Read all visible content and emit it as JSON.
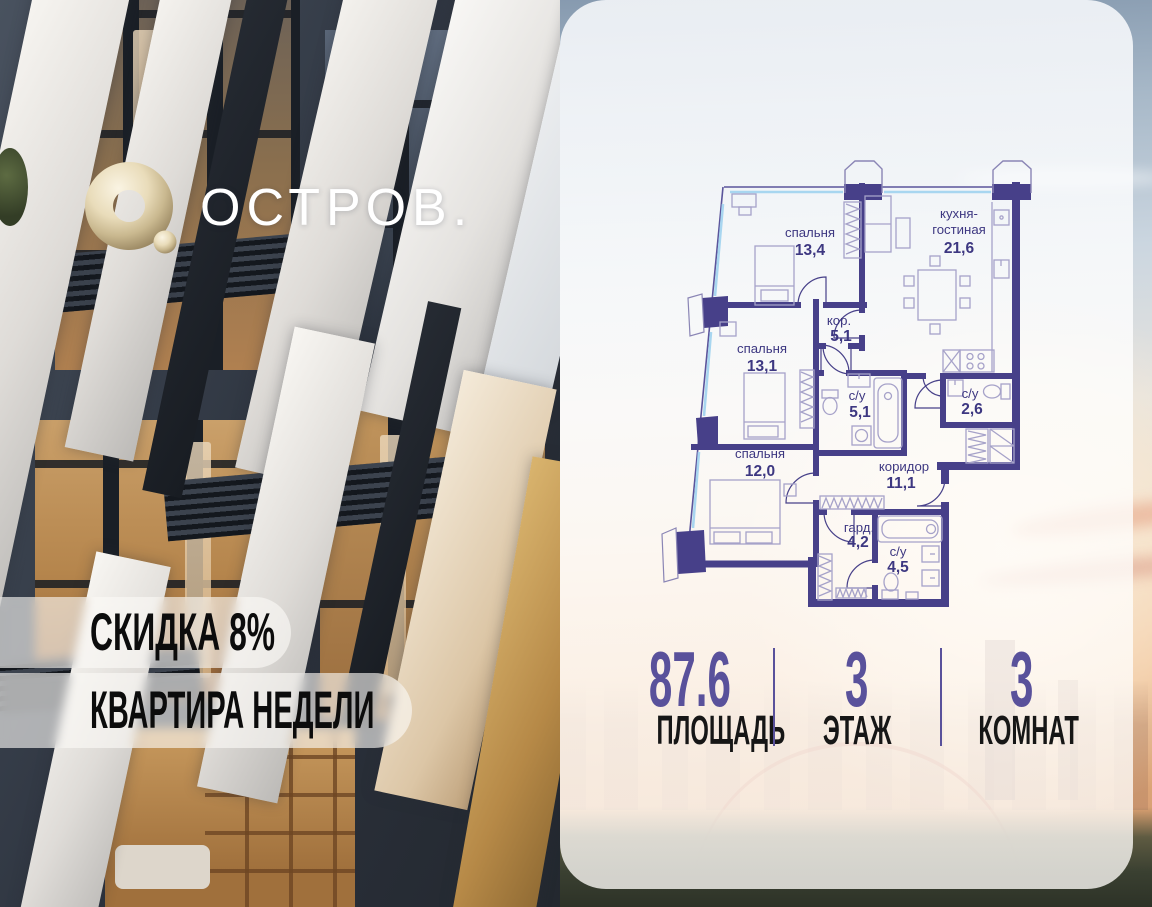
{
  "logo": {
    "brand": "ОСТРОВ."
  },
  "badges": {
    "discount": "СКИДКА 8%",
    "week": "КВАРТИРА НЕДЕЛИ"
  },
  "plan": {
    "rooms": [
      {
        "name": "спальня",
        "area": "13,4"
      },
      {
        "name1": "кухня-",
        "name2": "гостиная",
        "area": "21,6"
      },
      {
        "name": "кор.",
        "area": "5,1"
      },
      {
        "name": "спальня",
        "area": "13,1"
      },
      {
        "name": "с/у",
        "area": "5,1"
      },
      {
        "name": "с/у",
        "area": "2,6"
      },
      {
        "name": "спальня",
        "area": "12,0"
      },
      {
        "name": "коридор",
        "area": "11,1"
      },
      {
        "name": "гард.",
        "area": "4,2"
      },
      {
        "name": "с/у",
        "area": "4,5"
      }
    ]
  },
  "stats": {
    "items": [
      {
        "value": "87.6",
        "label": "ПЛОЩАДЬ"
      },
      {
        "value": "3",
        "label": "ЭТАЖ"
      },
      {
        "value": "3",
        "label": "КОМНАТ"
      }
    ]
  },
  "colors": {
    "wall": "#474089",
    "plan_text": "#3d3781",
    "window_glass": "#a8d6f0",
    "accent_purple": "#59519b",
    "logo_gold": "#d8c69f"
  }
}
